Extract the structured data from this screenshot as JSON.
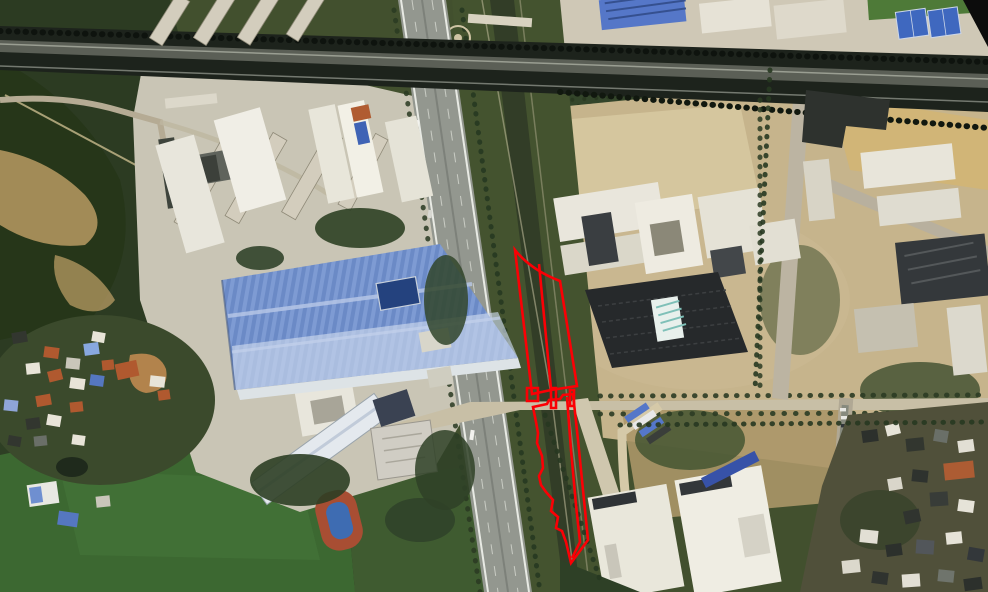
{
  "meta": {
    "title": "Satellite aerial map with red parcel boundary annotation",
    "canvas": {
      "width": 988,
      "height": 592
    }
  },
  "annotation": {
    "color": "#fb0005",
    "stroke_width": 2.6,
    "shapes": [
      {
        "name": "upper-parcel-outline",
        "d": "M515,250 Q531,270 560,281 L577,386 L551,390 L532,394 Z"
      },
      {
        "name": "upper-parcel-divider",
        "d": "M539,264 L551,389"
      },
      {
        "name": "road-parcel-a",
        "d": "M527,388 h11 v13 h-11 Z"
      },
      {
        "name": "road-parcel-b",
        "d": "M551,388 h5 v20 h-5 Z"
      },
      {
        "name": "road-parcel-c",
        "d": "M570,390 h4 v16 h-4 Z"
      },
      {
        "name": "lower-parcel-outline",
        "d": "M533,407 L547,404 L549,400 L560,399 L563,395 L573,394 L578,440 L583,490 L588,540 L571,563 L566,542 L562,531 L556,528 L558,517 L551,511 L553,500 L546,492 L541,485 L539,476 L543,468 L542,456 L537,443 L538,433 L536,422 Z"
      },
      {
        "name": "lower-parcel-divider",
        "d": "M567,397 L571,450 L576,505 L580,542 L572,558"
      }
    ]
  },
  "compass": {
    "name": "north-arrow",
    "color": "#0c0c0c",
    "position": "top-right"
  },
  "palette": {
    "forest_green": "#2c3b22",
    "field_green": "#3c6831",
    "canal_water": "#323d27",
    "asphalt": "#93978f",
    "rail_corridor": "#1d231c",
    "tan_ground": "#c6b48c",
    "white_roof": "#eceade",
    "blue_factory_roof": "#7e9bd3",
    "dark_roof": "#33373a",
    "orange_roof": "#b05a30"
  }
}
